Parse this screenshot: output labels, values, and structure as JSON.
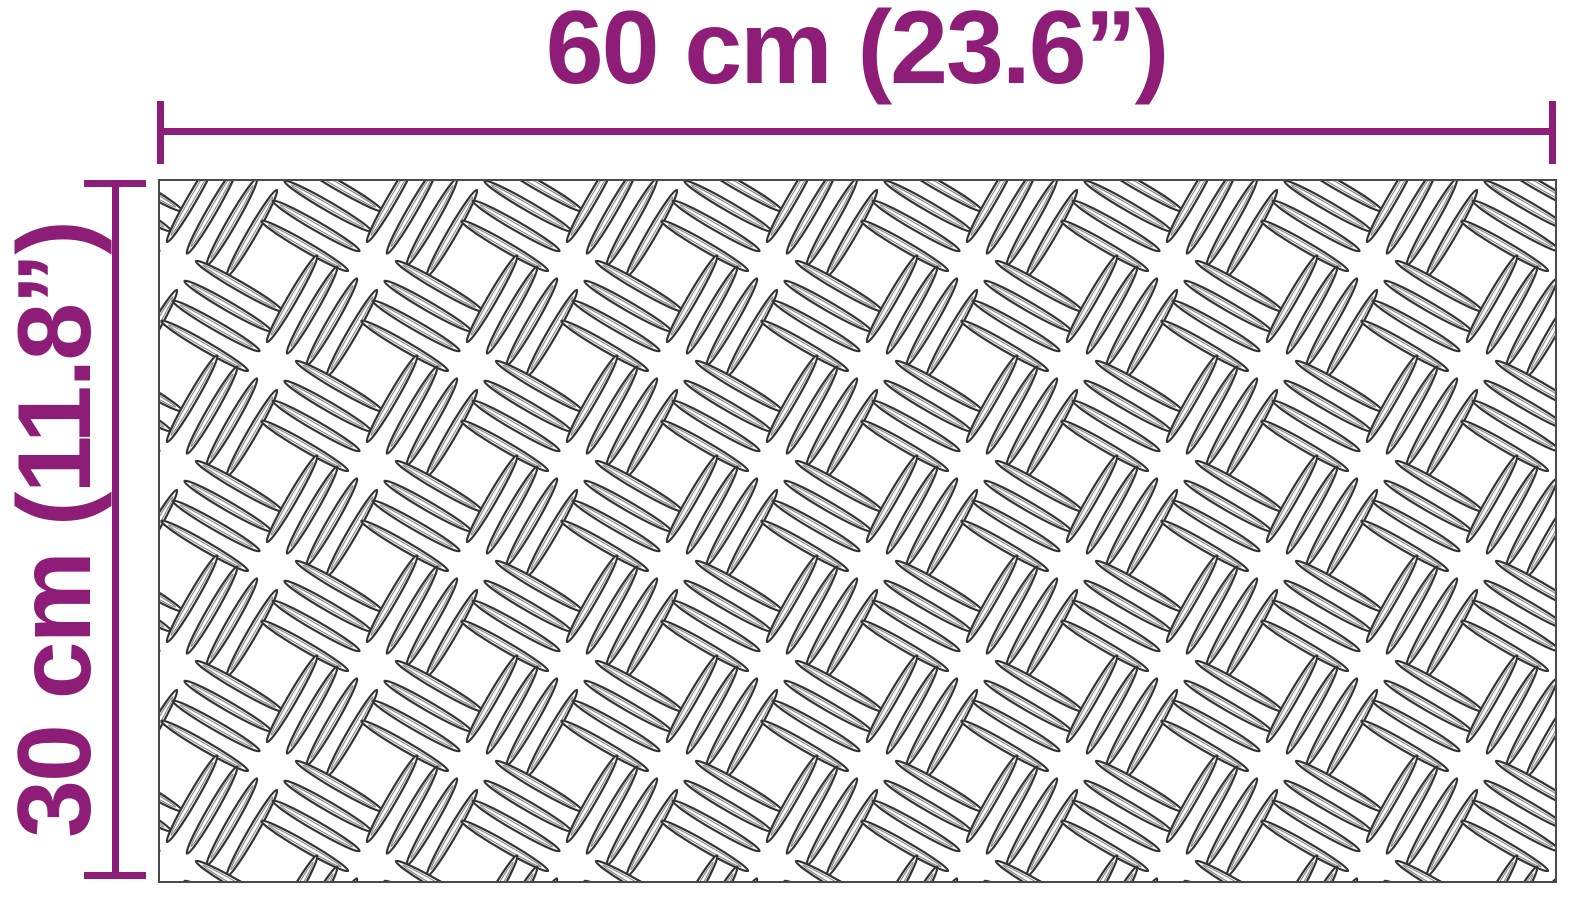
{
  "colors": {
    "accent": "#8d1d76",
    "plate-border": "#4a4a4a",
    "mark-stroke": "#333333",
    "mark-inner": "#8a8a8a",
    "plate-bg": "#ffffff"
  },
  "dimensions": {
    "width": {
      "label": "60 cm (23.6”)"
    },
    "height": {
      "label": "30 cm (11.8”)"
    }
  },
  "plate": {
    "texture": "aluminium-checker-plate-tread-marks"
  }
}
